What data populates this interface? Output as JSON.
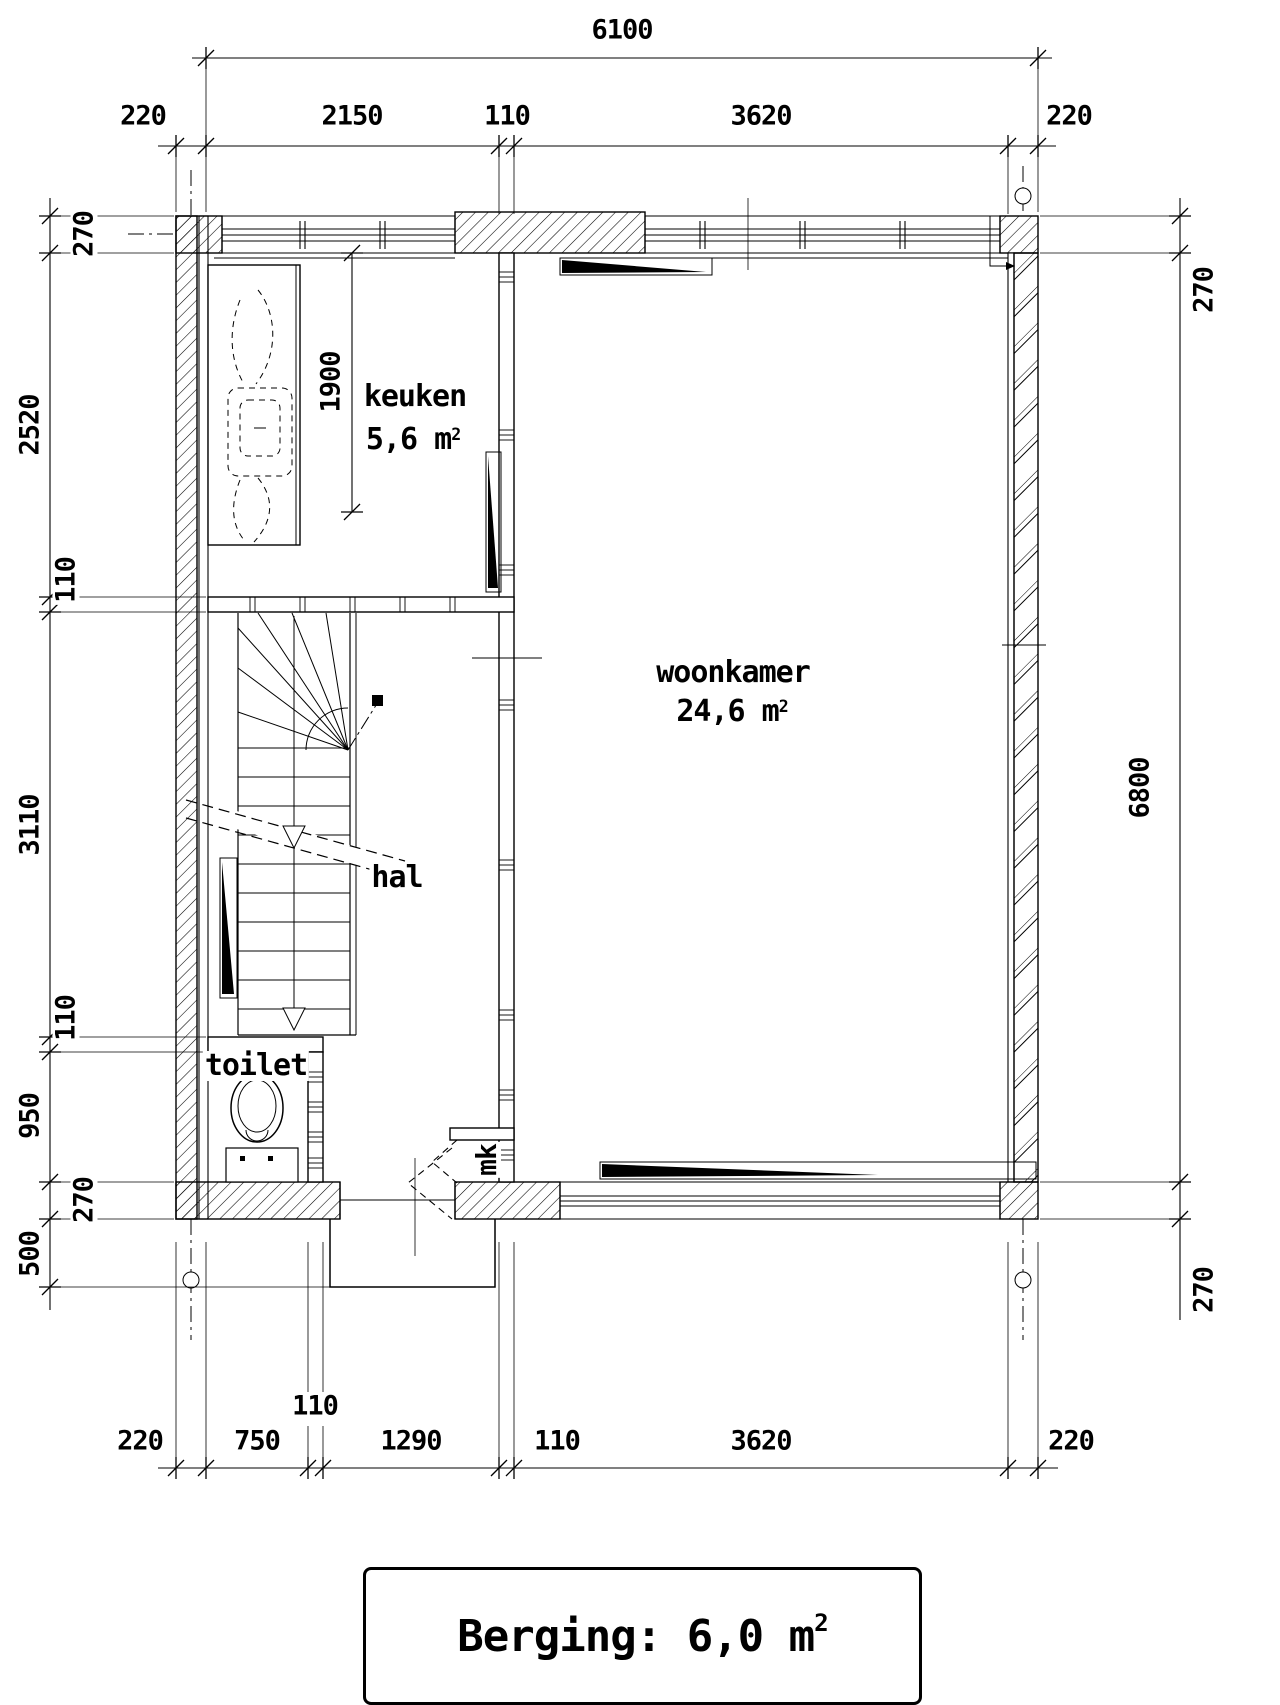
{
  "title_block": {
    "text": "Berging: 6,0 m",
    "sup": "2"
  },
  "rooms": {
    "keuken": {
      "name": "keuken",
      "area": "5,6 m",
      "area_sup": "2"
    },
    "woonkamer": {
      "name": "woonkamer",
      "area": "24,6 m",
      "area_sup": "2"
    },
    "hal": {
      "name": "hal"
    },
    "toilet": {
      "name": "toilet"
    },
    "mk": {
      "name": "mk"
    }
  },
  "dims": {
    "top": {
      "overall": "6100",
      "segments": [
        "220",
        "2150",
        "110",
        "3620",
        "220"
      ]
    },
    "left": [
      "270",
      "2520",
      "110",
      "3110",
      "110",
      "950",
      "270",
      "500"
    ],
    "right": [
      "270",
      "6800",
      "270"
    ],
    "bottom": [
      "220",
      "750",
      "110",
      "1290",
      "110",
      "3620",
      "220"
    ],
    "interior": {
      "keuken_depth": "1900"
    }
  },
  "colors": {
    "ink": "#000000",
    "paper": "#ffffff"
  }
}
